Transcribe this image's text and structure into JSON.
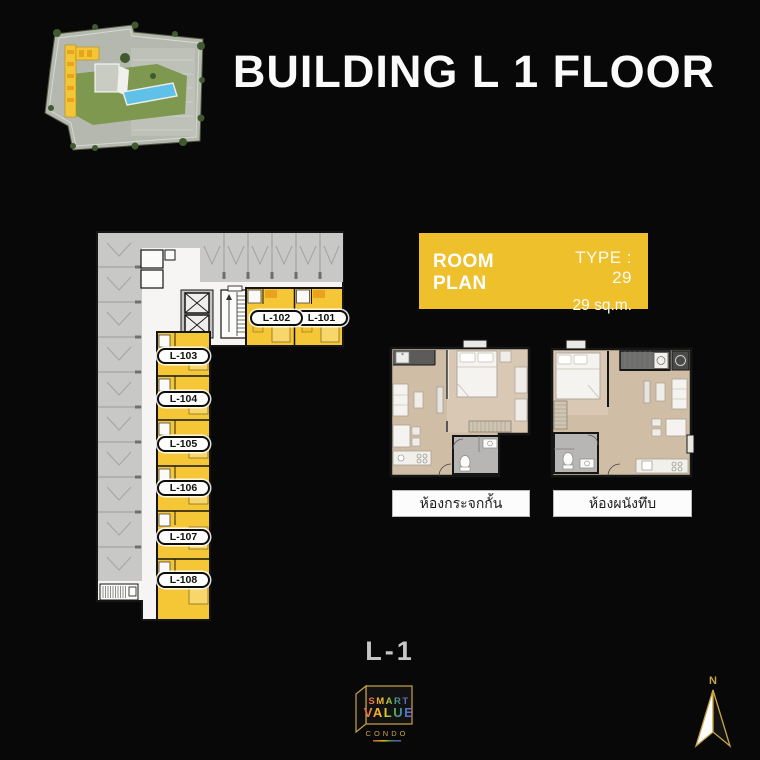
{
  "title": "BUILDING L 1 FLOOR",
  "floor_plan": {
    "units": [
      "L-101",
      "L-102",
      "L-103",
      "L-104",
      "L-105",
      "L-106",
      "L-107",
      "L-108"
    ]
  },
  "room_plan": {
    "heading": "ROOM PLAN",
    "type": "TYPE : 29",
    "area": "29 sq.m.",
    "variants": [
      "ห้องกระจกกั้น",
      "ห้องผนังทึบ"
    ]
  },
  "footer": {
    "floor_label": "L-1"
  },
  "logo": {
    "word1": "SMART",
    "word2": "VALUE",
    "word3": "CONDO"
  },
  "compass": {
    "north": "N"
  },
  "colors": {
    "background": "#080808",
    "unit_yellow": "#F5C737",
    "panel_yellow": "#EEC02C",
    "parking_gray": "#C8C8C6",
    "gold": "#C9A44A",
    "pool_blue": "#5FC0E8"
  }
}
